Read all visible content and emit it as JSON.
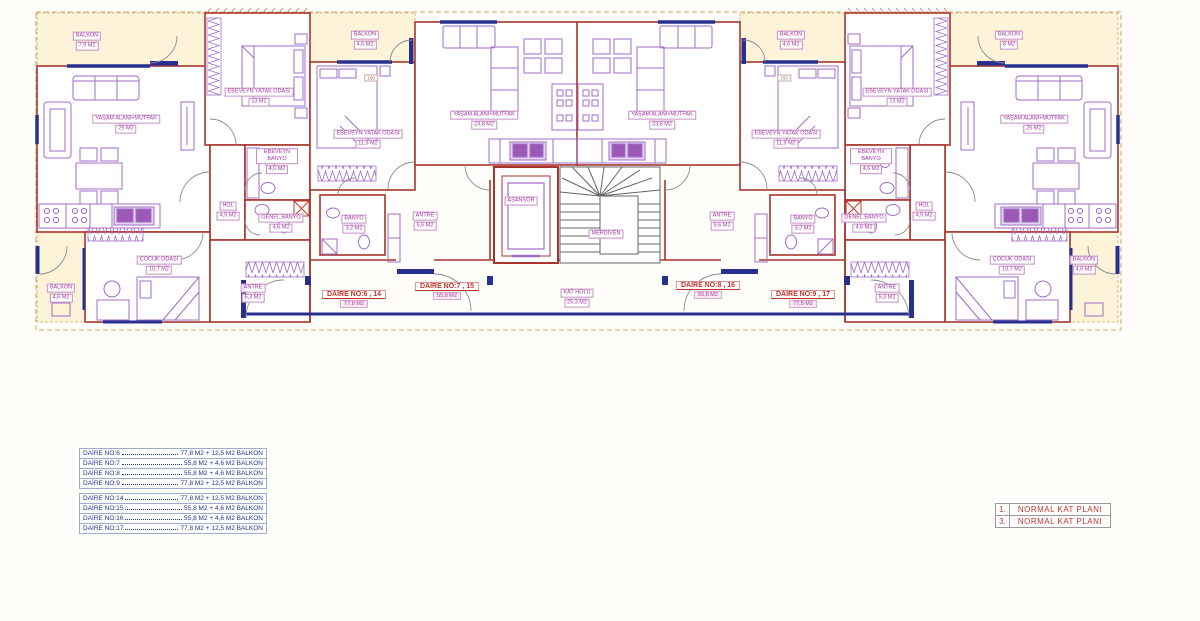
{
  "colors": {
    "wall": "#a8352b",
    "window": "#27308f",
    "furniture": "#a06cc8",
    "label_magenta": "#a833a8",
    "label_red": "#c2342c",
    "balcony_fill": "#fdf3d8",
    "site_line": "#d2a75f",
    "legend_text": "#24348c"
  },
  "plan": {
    "labels": {
      "balkon_6_top": {
        "name": "BALKON",
        "area": "7,9 M2"
      },
      "yasam_6": {
        "name": "YAŞAM ALANI+MUTFAK",
        "area": "25 M2"
      },
      "ebeveyn_yatak_6": {
        "name": "EBEVEYN YATAK ODASI",
        "area": "13 M2"
      },
      "ebeveyn_banyo_6": {
        "name": "EBEVEYN BANYO",
        "area": "4,6 M2"
      },
      "hol_6": {
        "name": "HOL",
        "area": "4,5 M2"
      },
      "genel_banyo_6": {
        "name": "GENEL BANYO",
        "area": "4,6 M2"
      },
      "cocuk_6": {
        "name": "ÇOCUK ODASI",
        "area": "10,7 M2"
      },
      "balkon_6_bottom": {
        "name": "BALKON",
        "area": "4,6 M2"
      },
      "antre_6": {
        "name": "ANTRE",
        "area": "5,3 M2"
      },
      "daire_6": {
        "name": "DAİRE NO:6 , 14",
        "area": "77,8 M2"
      },
      "balkon_7": {
        "name": "BALKON",
        "area": "4,6 M2"
      },
      "dim_7": "160",
      "ebeveyn_yatak_7": {
        "name": "EBEVEYN YATAK ODASI",
        "area": "11,9 M2"
      },
      "yasam_7": {
        "name": "YAŞAM ALANI+MUTFAK",
        "area": "23,8 M2"
      },
      "banyo_7": {
        "name": "BANYO",
        "area": "3,2 M2"
      },
      "antre_7": {
        "name": "ANTRE",
        "area": "5,6 M2"
      },
      "daire_7": {
        "name": "DAİRE NO:7 , 15",
        "area": "55,8 M2"
      },
      "asansor": {
        "name": "ASANSÖR"
      },
      "merdiven": {
        "name": "MERDİVEN"
      },
      "kat_holu": {
        "name": "KAT HOLÜ",
        "area": "25,3 M2"
      },
      "yasam_8": {
        "name": "YAŞAM ALANI+MUTFAK",
        "area": "23,8 M2"
      },
      "balkon_8": {
        "name": "BALKON",
        "area": "4,6 M2"
      },
      "dim_8": "160",
      "ebeveyn_yatak_8": {
        "name": "EBEVEYN YATAK ODASI",
        "area": "11,9 M2"
      },
      "antre_8": {
        "name": "ANTRE",
        "area": "5,6 M2"
      },
      "banyo_8": {
        "name": "BANYO",
        "area": "3,2 M2"
      },
      "daire_8": {
        "name": "DAİRE NO:8 , 16",
        "area": "55,8 M2"
      },
      "ebeveyn_yatak_9": {
        "name": "EBEVEYN YATAK ODASI",
        "area": "13 M2"
      },
      "yasam_9": {
        "name": "YAŞAM ALANI+MUTFAK",
        "area": "25 M2"
      },
      "balkon_9_top": {
        "name": "BALKON",
        "area": "8 M2"
      },
      "ebeveyn_banyo_9": {
        "name": "EBEVEYN BANYO",
        "area": "4,6 M2"
      },
      "hol_9": {
        "name": "HOL",
        "area": "4,5 M2"
      },
      "genel_banyo_9": {
        "name": "GENEL BANYO",
        "area": "4,6 M2"
      },
      "cocuk_9": {
        "name": "ÇOCUK ODASI",
        "area": "10,7 M2"
      },
      "balkon_9_bottom": {
        "name": "BALKON",
        "area": "4,6 M2"
      },
      "antre_9": {
        "name": "ANTRE",
        "area": "5,3 M2"
      },
      "daire_9": {
        "name": "DAİRE NO:9 , 17",
        "area": "77,8 M2"
      }
    }
  },
  "legend": {
    "rows": [
      {
        "label": "DAİRE NO:6",
        "value": "77,8 M2 + 12,5 M2 BALKON"
      },
      {
        "label": "DAİRE NO:7",
        "value": "55,8 M2 + 4,6 M2 BALKON"
      },
      {
        "label": "DAİRE NO:8",
        "value": "55,8 M2 + 4,6 M2 BALKON"
      },
      {
        "label": "DAİRE NO:9",
        "value": "77,8 M2 + 12,5 M2 BALKON"
      },
      {
        "label": "DAİRE NO:14",
        "value": "77,8 M2 + 12,5 M2 BALKON"
      },
      {
        "label": "DAİRE NO:15",
        "value": "55,8 M2 + 4,6 M2 BALKON"
      },
      {
        "label": "DAİRE NO:16",
        "value": "55,8 M2 + 4,6 M2 BALKON"
      },
      {
        "label": "DAİRE NO:17",
        "value": "77,8 M2 + 12,5 M2 BALKON"
      }
    ]
  },
  "titleblock": {
    "rows": [
      {
        "num": "1.",
        "label": "NORMAL KAT PLANI"
      },
      {
        "num": "3.",
        "label": "NORMAL KAT PLANI"
      }
    ]
  }
}
